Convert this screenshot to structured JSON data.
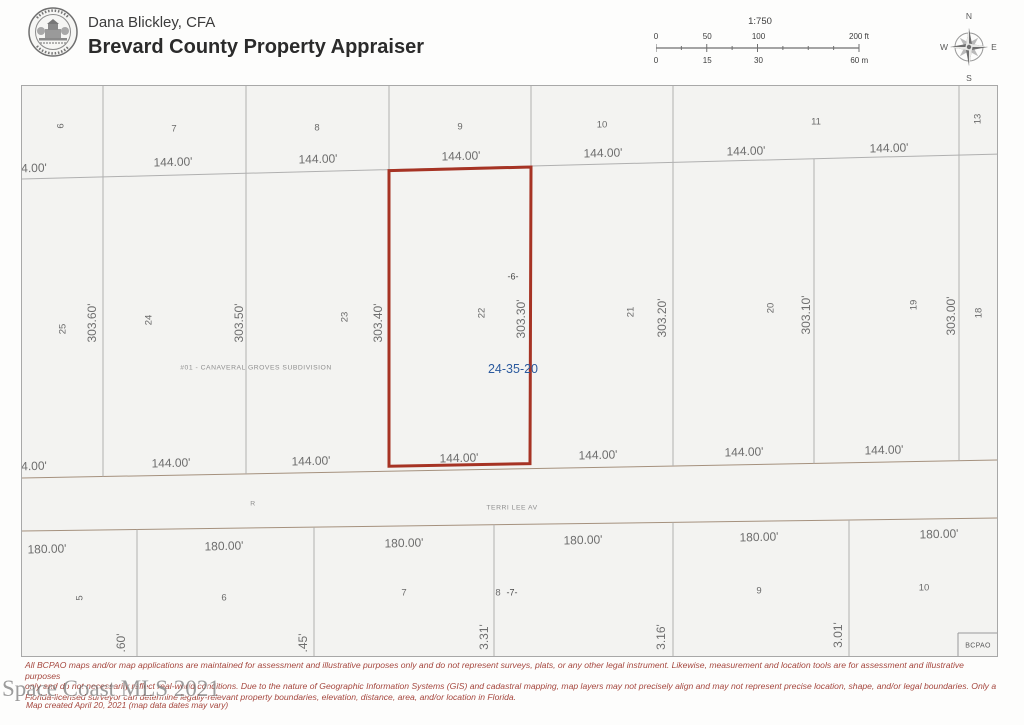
{
  "header": {
    "owner": "Dana Blickley, CFA",
    "office": "Brevard County Property Appraiser",
    "logo": "brevard-county-property-appraiser-seal"
  },
  "scale_bar": {
    "ratio": "1:750",
    "feet_labels": [
      "0",
      "50",
      "100",
      "200 ft"
    ],
    "meter_labels": [
      "0",
      "15",
      "30",
      "60 m"
    ]
  },
  "compass": {
    "north": "N",
    "east": "E",
    "south": "S",
    "west": "W"
  },
  "map": {
    "subdivision_label": {
      "t": "#01 - CANAVERAL GROVES SUBDIVISION",
      "x": 255,
      "y": 368
    },
    "parcel_id": {
      "t": "24-35-20",
      "x": 512,
      "y": 368
    },
    "street_label": {
      "t": "TERRI LEE AV",
      "x": 511,
      "y": 508
    },
    "road_marker": {
      "t": "R",
      "x": 252,
      "y": 504
    },
    "bcpao_label": {
      "t": "BCPAO",
      "x": 977,
      "y": 645
    },
    "section_markers": [
      {
        "t": "-6-",
        "x": 512,
        "y": 276
      },
      {
        "t": "-7-",
        "x": 511,
        "y": 592
      }
    ],
    "lot_numbers": [
      {
        "t": "6",
        "x": 60,
        "y": 125,
        "r": 1
      },
      {
        "t": "7",
        "x": 173,
        "y": 128
      },
      {
        "t": "8",
        "x": 316,
        "y": 127
      },
      {
        "t": "9",
        "x": 459,
        "y": 126
      },
      {
        "t": "10",
        "x": 601,
        "y": 124
      },
      {
        "t": "11",
        "x": 815,
        "y": 121
      },
      {
        "t": "13",
        "x": 977,
        "y": 118,
        "r": 1
      },
      {
        "t": "25",
        "x": 62,
        "y": 328,
        "r": 1
      },
      {
        "t": "24",
        "x": 148,
        "y": 319,
        "r": 1
      },
      {
        "t": "23",
        "x": 344,
        "y": 316,
        "r": 1
      },
      {
        "t": "22",
        "x": 481,
        "y": 312,
        "r": 1
      },
      {
        "t": "21",
        "x": 630,
        "y": 311,
        "r": 1
      },
      {
        "t": "20",
        "x": 770,
        "y": 307,
        "r": 1
      },
      {
        "t": "19",
        "x": 913,
        "y": 304,
        "r": 1
      },
      {
        "t": "18",
        "x": 978,
        "y": 312,
        "r": 1
      },
      {
        "t": "5",
        "x": 79,
        "y": 597,
        "r": 1
      },
      {
        "t": "6",
        "x": 223,
        "y": 597
      },
      {
        "t": "7",
        "x": 403,
        "y": 592
      },
      {
        "t": "8",
        "x": 497,
        "y": 592
      },
      {
        "t": "9",
        "x": 758,
        "y": 590
      },
      {
        "t": "10",
        "x": 923,
        "y": 587
      }
    ],
    "dim_top": [
      {
        "t": "4.00'",
        "x": 33,
        "y": 167
      },
      {
        "t": "144.00'",
        "x": 172,
        "y": 161
      },
      {
        "t": "144.00'",
        "x": 317,
        "y": 158
      },
      {
        "t": "144.00'",
        "x": 460,
        "y": 155
      },
      {
        "t": "144.00'",
        "x": 602,
        "y": 152
      },
      {
        "t": "144.00'",
        "x": 745,
        "y": 150
      },
      {
        "t": "144.00'",
        "x": 888,
        "y": 147
      }
    ],
    "dim_mid": [
      {
        "t": "4.00'",
        "x": 33,
        "y": 465
      },
      {
        "t": "144.00'",
        "x": 170,
        "y": 462
      },
      {
        "t": "144.00'",
        "x": 310,
        "y": 460
      },
      {
        "t": "144.00'",
        "x": 458,
        "y": 457
      },
      {
        "t": "144.00'",
        "x": 597,
        "y": 454
      },
      {
        "t": "144.00'",
        "x": 743,
        "y": 451
      },
      {
        "t": "144.00'",
        "x": 883,
        "y": 449
      }
    ],
    "dim_bottom": [
      {
        "t": "180.00'",
        "x": 46,
        "y": 548
      },
      {
        "t": "180.00'",
        "x": 223,
        "y": 545
      },
      {
        "t": "180.00'",
        "x": 403,
        "y": 542
      },
      {
        "t": "180.00'",
        "x": 582,
        "y": 539
      },
      {
        "t": "180.00'",
        "x": 758,
        "y": 536
      },
      {
        "t": "180.00'",
        "x": 938,
        "y": 533
      }
    ],
    "dim_vertical": [
      {
        "t": "303.60'",
        "x": 91,
        "y": 322
      },
      {
        "t": "303.50'",
        "x": 238,
        "y": 322
      },
      {
        "t": "303.40'",
        "x": 377,
        "y": 322
      },
      {
        "t": "303.30'",
        "x": 520,
        "y": 318
      },
      {
        "t": "303.20'",
        "x": 661,
        "y": 317
      },
      {
        "t": "303.10'",
        "x": 805,
        "y": 314
      },
      {
        "t": "303.00'",
        "x": 950,
        "y": 315
      }
    ],
    "dim_vertical_cut": [
      {
        "t": ".60'",
        "x": 120,
        "y": 642
      },
      {
        "t": ".45'",
        "x": 302,
        "y": 642
      },
      {
        "t": "3.31'",
        "x": 483,
        "y": 636
      },
      {
        "t": "3.16'",
        "x": 660,
        "y": 636
      },
      {
        "t": "3.01'",
        "x": 837,
        "y": 634
      }
    ]
  },
  "footer": {
    "watermark": "Space Coast MLS 2021",
    "disclaimer_lines": [
      "All BCPAO maps and/or map applications are maintained for assessment and illustrative purposes only and do not represent surveys, plats, or any other legal instrument. Likewise, measurement and location tools are for assessment and illustrative purposes",
      "only and do not necessarily reflect real-world conditions. Due to the nature of Geographic Information Systems (GIS) and cadastral mapping, map layers may not precisely align and may not represent precise location, shape, and/or legal boundaries. Only a",
      "Florida-licensed surveyor can determine legally-relevant property boundaries, elevation, distance, area, and/or location in Florida."
    ],
    "map_created": "Map created April 20, 2021 (map data dates may vary)"
  },
  "colors": {
    "parcel_highlight": "#a63324",
    "parcel_id_text": "#2b5a9e",
    "lot_line": "#b0b0b0",
    "street_line": "#a5917e",
    "label_gray": "#6e6e6e",
    "disclaimer_red": "#a5473e"
  }
}
